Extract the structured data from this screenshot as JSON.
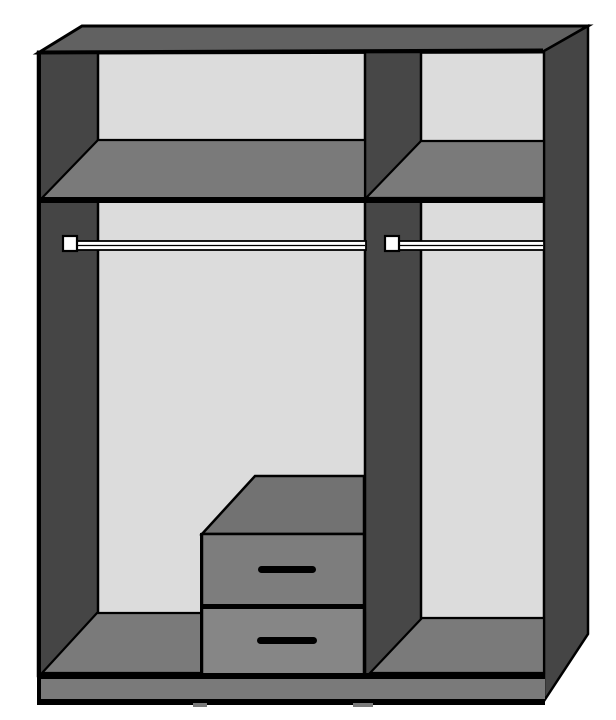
{
  "diagram": {
    "title": "Wardrobe interior cutaway diagram",
    "type": "furniture-line-drawing",
    "compartments": {
      "left": {
        "parts": [
          "top-shelf",
          "hanging-rail",
          "drawer-unit",
          "floor-panel"
        ]
      },
      "right": {
        "parts": [
          "top-shelf",
          "hanging-rail",
          "floor-panel"
        ]
      }
    },
    "drawer_unit": {
      "drawer_count": 2,
      "handles_per_drawer": 1
    },
    "counts": {
      "shelves": 2,
      "hanging_rails": 2,
      "rail_brackets": 2,
      "drawers": 2,
      "vertical_dividers": 1
    }
  },
  "colors": {
    "background": "#ffffff",
    "outline": "#000000",
    "top_face": "#616161",
    "side_panel": "#454545",
    "divider_panel": "#474747",
    "interior_back": "#dcdcdc",
    "shelf_surface": "#7a7a7a",
    "plinth": "#7a7a7a",
    "drawer_top": "#727272",
    "drawer_front_upper": "#7d7d7d",
    "drawer_front_lower": "#868686",
    "handle": "#000000",
    "rail_fill": "#ffffff"
  }
}
